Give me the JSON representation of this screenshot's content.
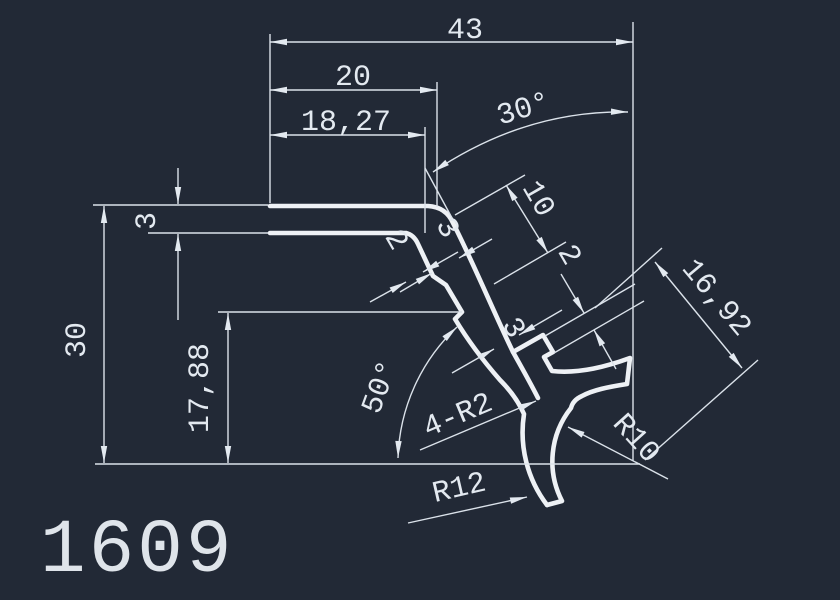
{
  "canvas": {
    "background_color": "#222936",
    "line_color": "#e3e9f0",
    "part_number": "1609"
  },
  "dimensions": {
    "total_width": "43",
    "upper_width": "20",
    "inner_width": "18,27",
    "plate_thickness": "3",
    "total_height": "30",
    "step_height": "17,88",
    "arm_length": "10",
    "notch_step": "2",
    "wall_upper": "3",
    "lip_step": "2",
    "wall_lower": "3",
    "diagonal_width": "16,92",
    "arm_angle": "30°",
    "hook_angle": "50°",
    "fillet_note": "4-R2",
    "hook_inner_radius": "R10",
    "hook_outer_radius": "R12"
  }
}
